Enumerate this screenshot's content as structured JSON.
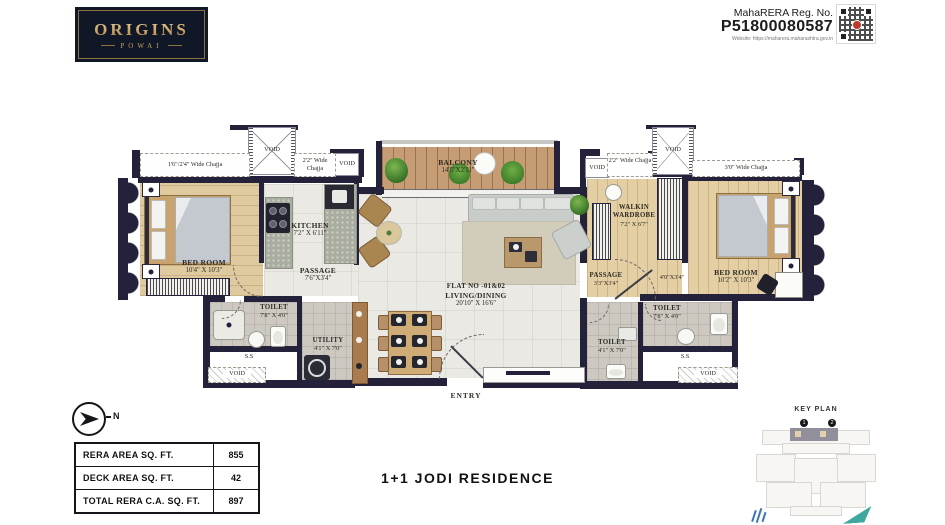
{
  "brand": {
    "name": "ORIGINS",
    "sub": "POWAI"
  },
  "rera": {
    "label": "MahaRERA Reg. No.",
    "number": "P51800080587",
    "website": "Website: https://maharera.maharashtra.gov.in"
  },
  "plan": {
    "void": "VOID",
    "ss": "S.S",
    "entry": "ENTRY",
    "flat_no": "FLAT NO -01&02",
    "foyer_dim": "4'0\"X3'4\"",
    "chajja": {
      "left": "1'6\"/2'4\" Wide Chajja",
      "left22": "2'2\" Wide Chajja",
      "right22": "2'2\" Wide Chajja",
      "right30": "3'0\" Wide Chajja"
    },
    "rooms": {
      "bedroom1": {
        "name": "BED ROOM",
        "dim": "10'4\" X 10'3\""
      },
      "kitchen": {
        "name": "KITCHEN",
        "dim": "7'2\" X 6'11\""
      },
      "passage_left": {
        "name": "PASSAGE",
        "dim": "7'6\"X3'4\""
      },
      "toilet_left": {
        "name": "TOILET",
        "dim": "7'8\" X 4'0\""
      },
      "utility": {
        "name": "UTILITY",
        "dim": "4'1\" X 7'0\""
      },
      "balcony": {
        "name": "BALCONY",
        "dim": "14'5\"X2'11\""
      },
      "living": {
        "name": "LIVING/DINING",
        "dim": "20'10\" X 16'6\""
      },
      "walkin": {
        "name": "WALKIN WARDROBE",
        "dim": "7'2\" X 6'7\""
      },
      "passage_right": {
        "name": "PASSAGE",
        "dim": "3'3\"X3'4\""
      },
      "bedroom2": {
        "name": "BED ROOM",
        "dim": "10'2\" X 10'3\""
      },
      "toilet_right_a": {
        "name": "TOILET",
        "dim": "4'1\" X 7'0\""
      },
      "toilet_right_b": {
        "name": "TOILET",
        "dim": "7'8\" X 4'0\""
      }
    }
  },
  "areas": {
    "rows": [
      {
        "label": "RERA AREA SQ. FT.",
        "value": "855"
      },
      {
        "label": "DECK AREA SQ. FT.",
        "value": "42"
      },
      {
        "label": "TOTAL RERA C.A. SQ. FT.",
        "value": "897"
      }
    ]
  },
  "footer": {
    "title": "1+1 JODI RESIDENCE"
  },
  "key_plan": {
    "title": "KEY PLAN",
    "marker1": "1",
    "marker2": "2"
  },
  "compass": {
    "north": "N"
  }
}
